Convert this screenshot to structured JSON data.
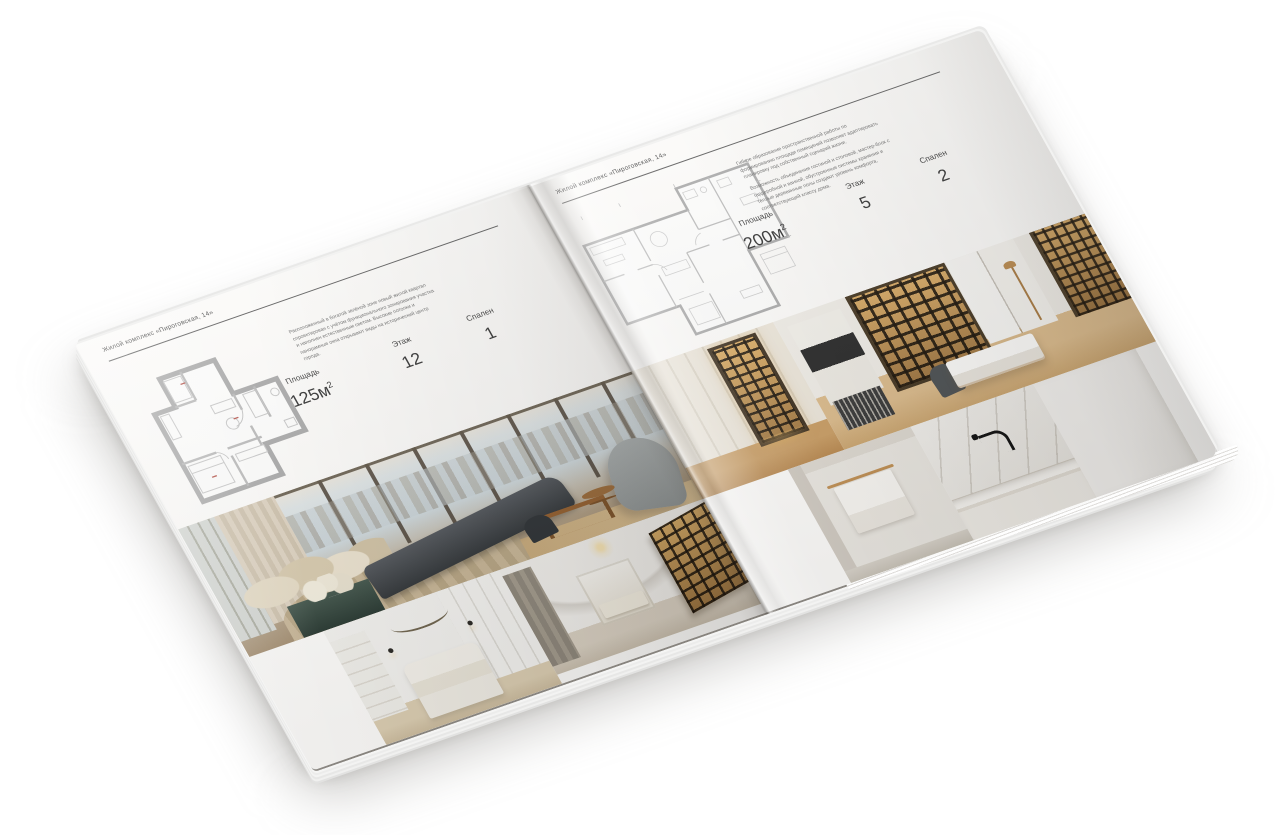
{
  "canvas": {
    "background": "#ffffff"
  },
  "brochure": {
    "project_name": "Жилой комплекс «Пироговская, 14»",
    "paper_color": "#fbfaf8",
    "accent_amber": "#c79a55",
    "accent_teal": "#3d5249",
    "wood_tone": "#caa26b",
    "left_page": {
      "header": "Жилой комплекс «Пироговская, 14»",
      "description": "Расположенный в богатой зелёной зоне новый жилой квартал спроектирован с учётом функционального зонирования участка и наполнен естественным светом. Высокие потолки и панорамные окна открывают виды на исторический центр города.",
      "stats": [
        {
          "label": "Площадь",
          "value": "125м",
          "sup": "2"
        },
        {
          "label": "Этаж",
          "value": "12"
        },
        {
          "label": "Спален",
          "value": "1"
        }
      ],
      "floor_plan": "apartment-plan-125m2",
      "photos": [
        "bedroom-window-city-view",
        "white-bedroom-canopy",
        "corridor-display-shelves"
      ]
    },
    "right_page": {
      "header": "Жилой комплекс «Пироговская, 14»",
      "description_1": "Гибкое образование пространственной работы по формированию площади помещений позволяет адаптировать планировку под собственный сценарий жизни.",
      "description_2": "Возможность объединения гостиной и столовой, мастер-блок с гардеробной и ванной, обустроенные системы хранения и тёплые деревянные полы создают уровень комфорта, соответствующий классу дома.",
      "stats": [
        {
          "label": "Площадь",
          "value": "200м",
          "sup": "2"
        },
        {
          "label": "Этаж",
          "value": "5"
        },
        {
          "label": "Спален",
          "value": "2"
        }
      ],
      "floor_plan": "apartment-plan-200m2",
      "photos": [
        "wardrobe-lit-shelves",
        "study-desk-bookcase",
        "bathroom-towel",
        "bathroom-sink-black-faucet",
        "white-wall"
      ]
    }
  }
}
